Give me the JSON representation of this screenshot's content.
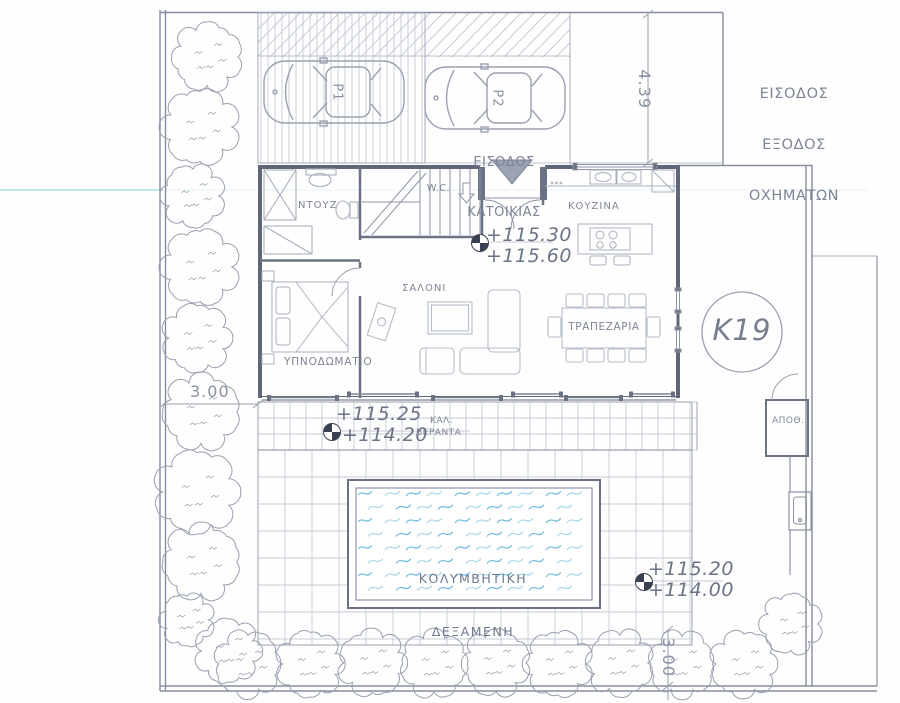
{
  "plan": {
    "vehicle_entrance": {
      "line1": "ΕΙΣΟΔΟΣ",
      "line2": "ΕΞΟΔΟΣ",
      "line3": "ΟΧΗΜΑΤΩΝ"
    },
    "house_entrance": {
      "line1": "ΕΙΣΟΔΟΣ",
      "line2": "ΚΑΤΟΙΚΙΑΣ"
    },
    "plot_label": "K19",
    "parking": {
      "space1": "P1",
      "space2": "P2"
    },
    "rooms": {
      "shower": "ΝΤΟΥΖ",
      "wc": "W.C.",
      "kitchen": "ΚΟΥΖΙΝΑ",
      "living": "ΣΑΛΟΝΙ",
      "dining": "ΤΡΑΠΕΖΑΡΙΑ",
      "bedroom": "ΥΠΝΟΔΩΜΑΤΙΟ",
      "storage": "ΑΠΟΘ."
    },
    "veranda": {
      "abbr": "ΚΑΛ.",
      "name": "ΒΕΡΑΝΤΑ"
    },
    "pool": {
      "line1": "ΚΟΛΥΜΒΗΤΙΚΗ",
      "line2": "ΔΕΞΑΜΕΝΗ"
    },
    "levels": {
      "interior_upper": "+115.30",
      "interior_lower": "+115.60",
      "veranda_upper": "+115.25",
      "veranda_lower": "+114.20",
      "pool_upper": "+115.20",
      "pool_lower": "+114.00"
    },
    "dimensions": {
      "driveway": "4.39",
      "left_setback": "3.00",
      "bottom_setback": "3.00"
    }
  },
  "colors": {
    "boundary": "#868da0",
    "wall": "#5f6678",
    "partition": "#6b7284",
    "furniture": "#a9b0bd",
    "tile": "#c6ccd7",
    "text": "#7e8596",
    "pool_wave_dark": "#5fb0d8",
    "pool_wave_light": "#9fd0e8",
    "scan_line": "#c2e4ef",
    "tree": "#989fae"
  }
}
